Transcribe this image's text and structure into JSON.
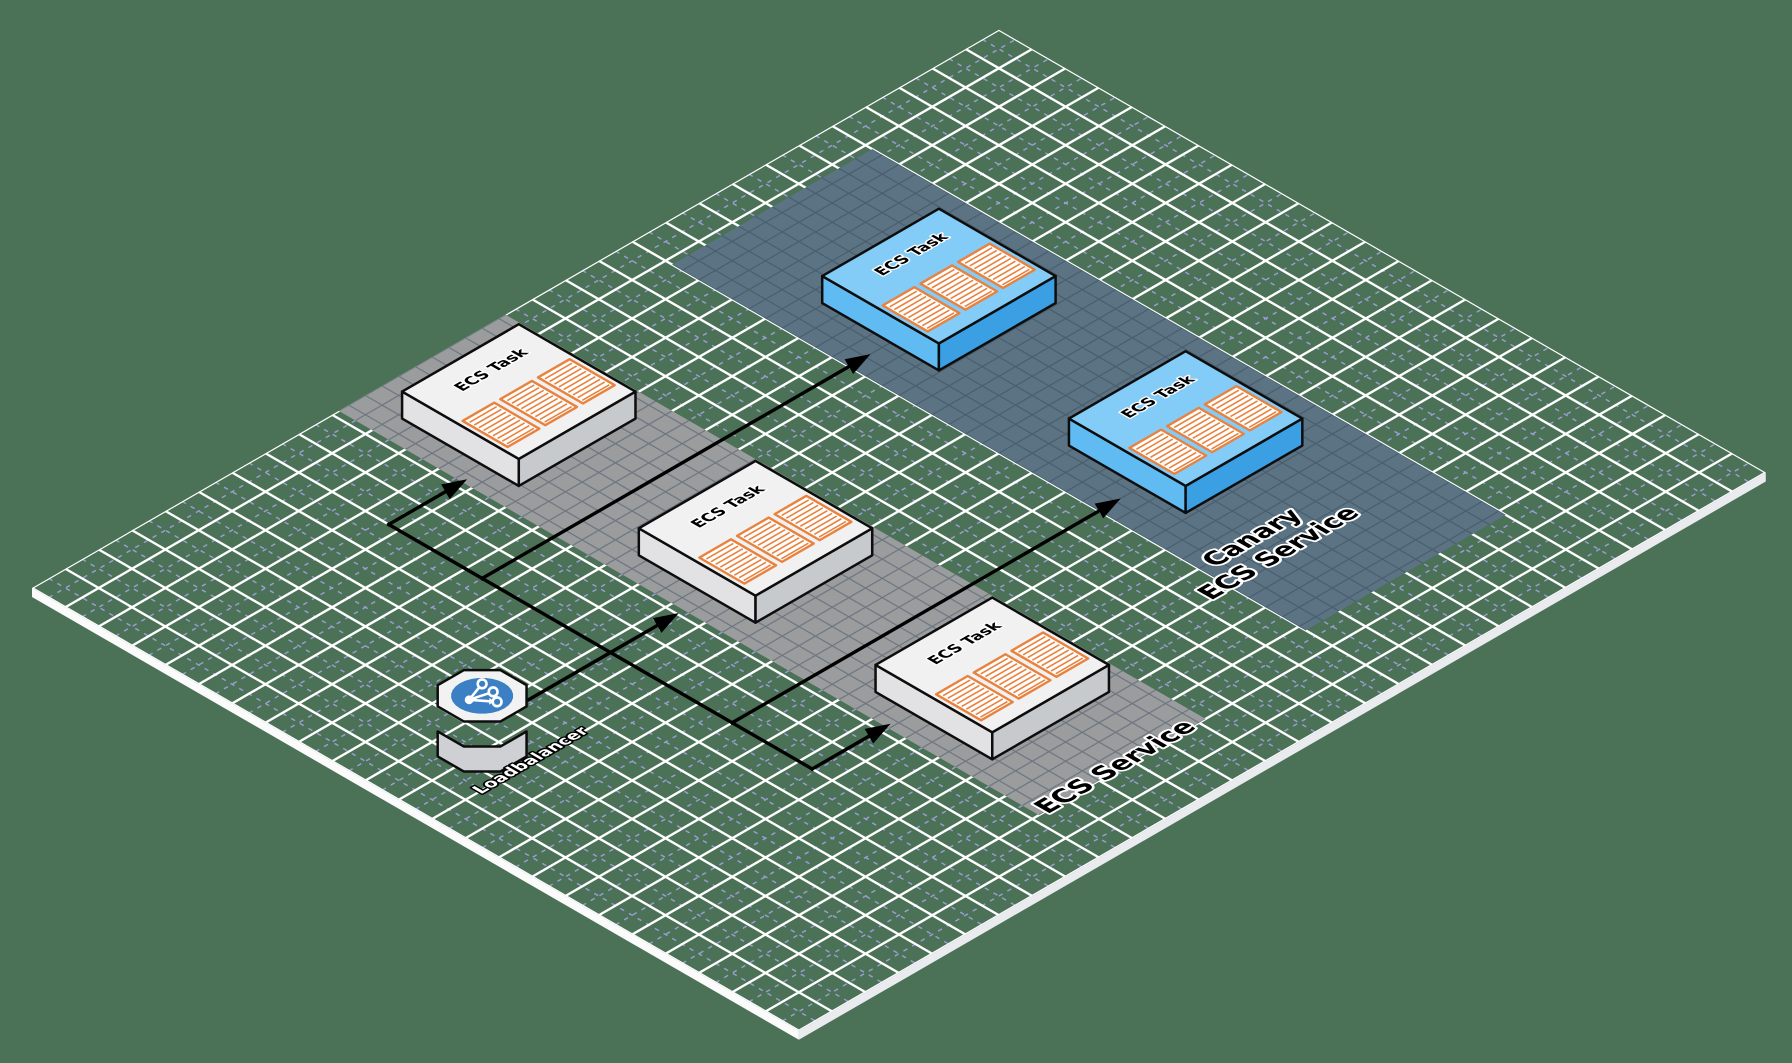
{
  "scene": {
    "width": 1792,
    "height": 1063,
    "bg": "#4b7157"
  },
  "iso": {
    "origin_x": 32,
    "origin_y": 588,
    "cell": 38.5,
    "cols": 29,
    "rows": 23,
    "plane_thickness": 9,
    "edge_front_color": "#fbfbfb",
    "edge_right_color": "#e9ebee",
    "grid": {
      "major": "#ffffff",
      "major_width": 2.4,
      "minor": "#989ed2",
      "minor_width": 1.5,
      "minor_dash": "4.5 5.5"
    }
  },
  "bands": [
    {
      "name": "ecs-service-band",
      "x0": 9.2,
      "y0": 0.0,
      "x1": 14.2,
      "y1": 21.0,
      "fill": "#9a9c9e",
      "grid": "#6f7780"
    },
    {
      "name": "canary-service-band",
      "x0": 18.0,
      "y0": 1.2,
      "x1": 24.0,
      "y1": 20.2,
      "fill": "#5b7383",
      "grid": "#4a5f6f"
    }
  ],
  "tasks": [
    {
      "name": "ecs-task-1",
      "label": "ECS Task",
      "x": 11.7,
      "y": 2.9,
      "variant": "gray"
    },
    {
      "name": "ecs-task-2",
      "label": "ECS Task",
      "x": 11.7,
      "y": 10.0,
      "variant": "gray"
    },
    {
      "name": "ecs-task-3",
      "label": "ECS Task",
      "x": 11.7,
      "y": 17.1,
      "variant": "gray"
    },
    {
      "name": "canary-task-1",
      "label": "ECS Task",
      "x": 21.0,
      "y": 6.2,
      "variant": "blue"
    },
    {
      "name": "canary-task-2",
      "label": "ECS Task",
      "x": 21.0,
      "y": 13.6,
      "variant": "blue"
    }
  ],
  "task_style": {
    "half": 1.75,
    "height": 27,
    "stroke": "#0d0d0d",
    "stroke_width": 2.5,
    "variants": {
      "gray": {
        "top": "#f1f1f1",
        "left": "#e2e2e4",
        "right": "#c7cacc"
      },
      "blue": {
        "top": "#84ccf8",
        "left": "#60bbf3",
        "right": "#3b9fe4"
      }
    },
    "label": {
      "size": 15.5,
      "dx": 0.15,
      "dy": -0.98,
      "fill": "#000000",
      "stroke": "#ffffff",
      "stroke_width": 3
    },
    "containers": {
      "count": 3,
      "w": 0.95,
      "l": 1.35,
      "gap": 0.18,
      "y0": -0.08,
      "fill": "#ffffff",
      "border": "#e8823e",
      "border_width": 2.4,
      "stripe": "#e8823e",
      "stripe_width": 1.6,
      "stripe_pitch": 0.14,
      "stripe_inset": 0.07
    }
  },
  "arrows": {
    "color": "#000000",
    "width": 3.4,
    "head_length": 25,
    "head_width": 17,
    "lines": [
      {
        "name": "trunk-line",
        "points": [
          [
            7.0,
            3.7
          ],
          [
            7.0,
            16.4
          ]
        ],
        "head": false
      },
      {
        "name": "arrow-to-task1",
        "points": [
          [
            7.0,
            3.7
          ],
          [
            9.35,
            3.7
          ]
        ],
        "head": true
      },
      {
        "name": "arrow-to-task3",
        "points": [
          [
            7.0,
            16.4
          ],
          [
            9.35,
            16.4
          ]
        ],
        "head": true
      },
      {
        "name": "arrow-lb-to-task2",
        "points": [
          [
            4.55,
            10.35
          ],
          [
            9.05,
            10.35
          ]
        ],
        "head": true
      },
      {
        "name": "arrow-to-canary1",
        "points": [
          [
            7.0,
            6.5
          ],
          [
            18.65,
            6.5
          ]
        ],
        "head": true
      },
      {
        "name": "arrow-to-canary2",
        "points": [
          [
            7.0,
            14.0
          ],
          [
            18.65,
            14.0
          ]
        ],
        "head": true
      }
    ]
  },
  "loadbalancer": {
    "name": "loadbalancer",
    "label": "Loadbalancer",
    "x": 3.3,
    "y": 10.2,
    "radius": 1.02,
    "disc_radius": 0.66,
    "height": 25,
    "top": "#f2f2f2",
    "side": "#cfd0d3",
    "stroke": "#0d0d0d",
    "disc": "#3b7fc4",
    "glyph": "#ffffff",
    "glyph_geo": {
      "dot": [
        -13,
        4
      ],
      "dot_r": 4.4,
      "branches": [
        [
          0,
          -12
        ],
        [
          11,
          -4
        ],
        [
          15,
          6
        ]
      ],
      "target_r": 4.4,
      "stroke_width": 2.6
    },
    "label_x": 3.0,
    "label_y": 11.95,
    "label_size": 16.5,
    "label_fill": "#ffffff",
    "label_stroke": "#000000",
    "label_stroke_width": 3.4
  },
  "labels": [
    {
      "name": "ecs-service-label",
      "lines": [
        "ECS Service"
      ],
      "x": 11.6,
      "y": 20.9,
      "size": 26,
      "fill": "#000000",
      "stroke": "#ffffff",
      "stroke_width": 4.5
    },
    {
      "name": "canary-service-label",
      "lines": [
        "Canary",
        "ECS Service"
      ],
      "x": 19.6,
      "y": 17.4,
      "size": 26,
      "fill": "#000000",
      "stroke": "#ffffff",
      "stroke_width": 4.5
    }
  ]
}
